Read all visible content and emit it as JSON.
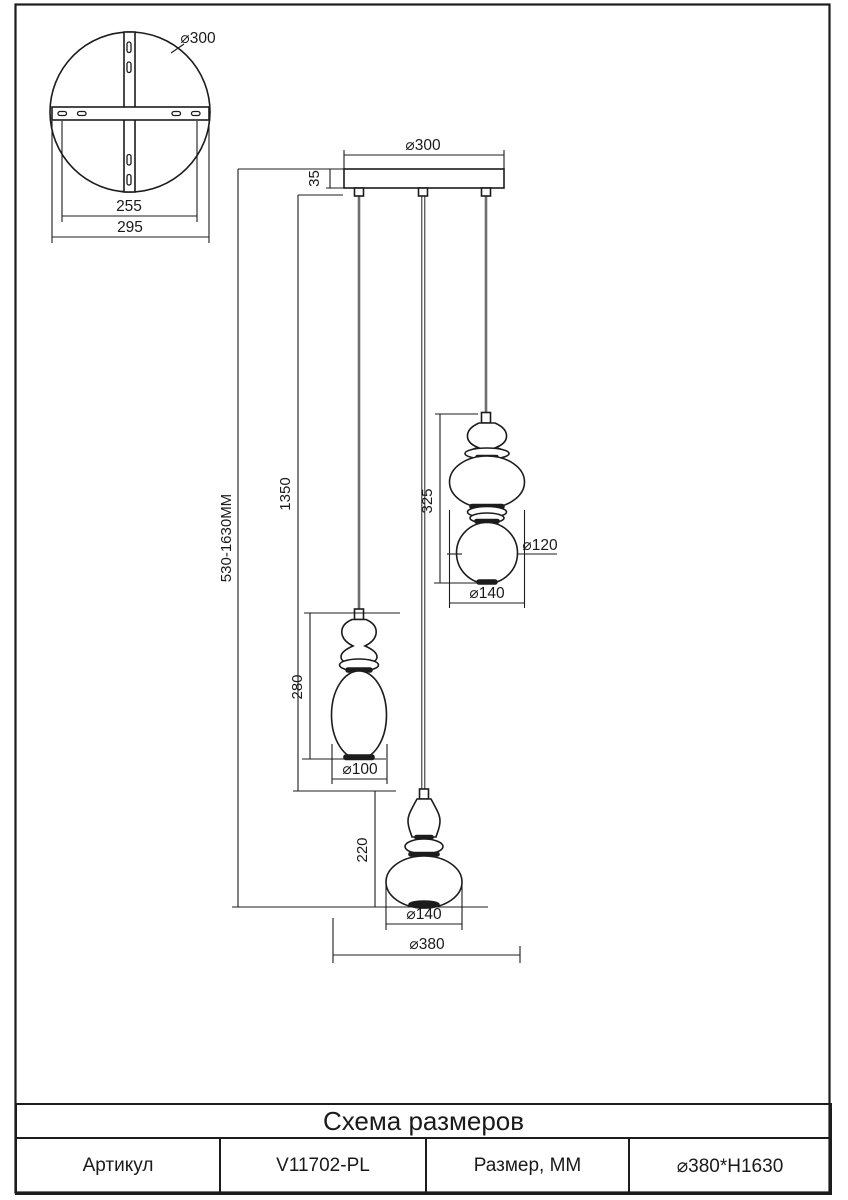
{
  "drawing": {
    "mount_view": {
      "diameter": "⌀300",
      "bracket_span": "255",
      "plate_span": "295"
    },
    "front_view": {
      "canopy_diameter": "⌀300",
      "canopy_height": "35",
      "overall_height": "530-1630MM",
      "cord_length": "1350",
      "middle_lamp": {
        "height": "280",
        "diameter": "⌀100"
      },
      "right_lamp": {
        "height": "325",
        "sphere_diameter": "⌀120",
        "body_diameter": "⌀140"
      },
      "bottom_lamp": {
        "height": "220",
        "diameter": "⌀140"
      },
      "overall_diameter": "⌀380"
    }
  },
  "table": {
    "title": "Схема размеров",
    "article_label": "Артикул",
    "article_value": "V11702-PL",
    "size_label": "Размер, ММ",
    "size_value": "⌀380*H1630"
  }
}
